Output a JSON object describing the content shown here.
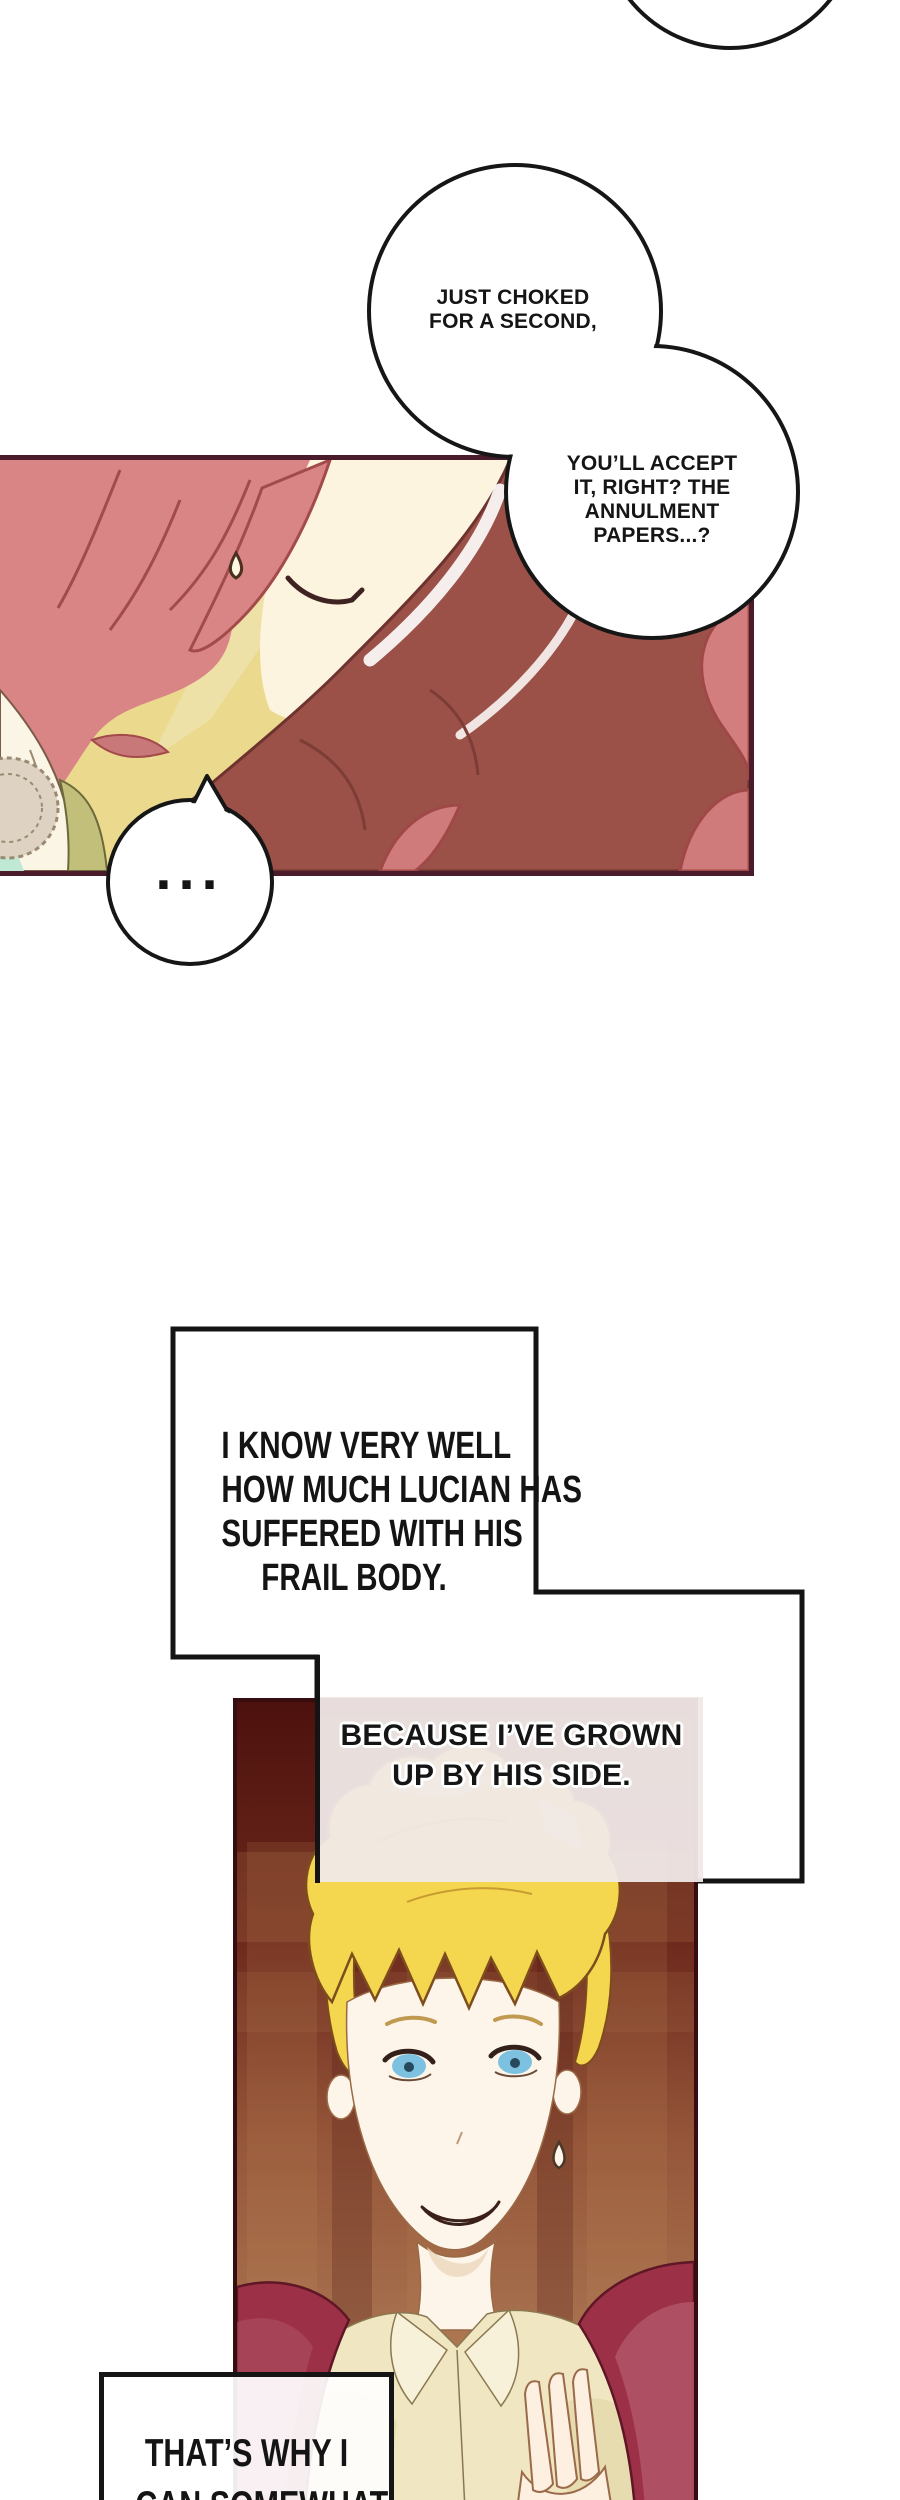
{
  "comic": {
    "bubble_choked": {
      "line1": "JUST CHOKED",
      "line2": "FOR A SECOND,"
    },
    "bubble_accept": {
      "line1": "YOU’LL ACCEPT",
      "line2": "IT, RIGHT? THE",
      "line3": "ANNULMENT",
      "line4": "PAPERS...?"
    },
    "bubble_ellipsis": {
      "text": "..."
    },
    "box_know": {
      "line1": "I KNOW VERY WELL",
      "line2": "HOW MUCH LUCIAN HAS",
      "line3": "SUFFERED WITH HIS",
      "line4": "FRAIL BODY."
    },
    "box_because": {
      "line1": "BECAUSE I’VE GROWN",
      "line2": "UP BY HIS SIDE."
    },
    "box_thats_why": {
      "line1": "THAT’S WHY I",
      "line2": "CAN SOMEWHAT"
    },
    "colors": {
      "page_bg": "#ffffff",
      "panel1_border": "#4a1b2a",
      "panel1_bg": "#ebd98e",
      "pink_hair": "#d98585",
      "dark_red_hair": "#9b5148",
      "skin": "#fcf4df",
      "panel2_border": "#380d11",
      "panel2_bg_top": "#4d110d",
      "panel2_bg_bottom": "#b07b55",
      "blonde_hair": "#f4d64f",
      "jacket_red": "#9c3046",
      "shirt_cream": "#f0e6c2",
      "bubble_stroke": "#161616",
      "box_stroke": "#141414"
    }
  }
}
